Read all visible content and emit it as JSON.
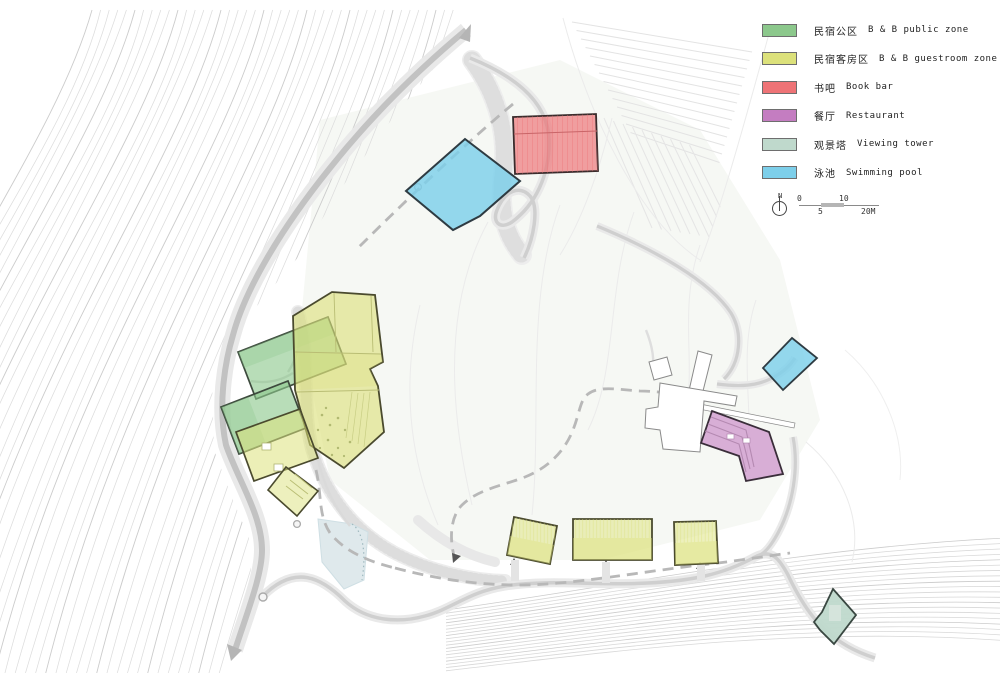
{
  "legend": {
    "items": [
      {
        "key": "public",
        "label_zh": "民宿公区",
        "label_en": "B & B public zone",
        "color": "#8CC88C"
      },
      {
        "key": "guestroom",
        "label_zh": "民宿客房区",
        "label_en": "B & B guestroom zone",
        "color": "#DCE17B"
      },
      {
        "key": "bookbar",
        "label_zh": "书吧",
        "label_en": "Book bar",
        "color": "#EE7376"
      },
      {
        "key": "restaurant",
        "label_zh": "餐厅",
        "label_en": "Restaurant",
        "color": "#C47DC1"
      },
      {
        "key": "tower",
        "label_zh": "观景塔",
        "label_en": "Viewing tower",
        "color": "#BFD9CC"
      },
      {
        "key": "pool",
        "label_zh": "泳池",
        "label_en": "Swimming pool",
        "color": "#7DCFEA"
      }
    ]
  },
  "compass": {
    "label": "N"
  },
  "scale_bar": {
    "t0": "0",
    "t5": "5",
    "t10": "10",
    "t20": "20M"
  }
}
